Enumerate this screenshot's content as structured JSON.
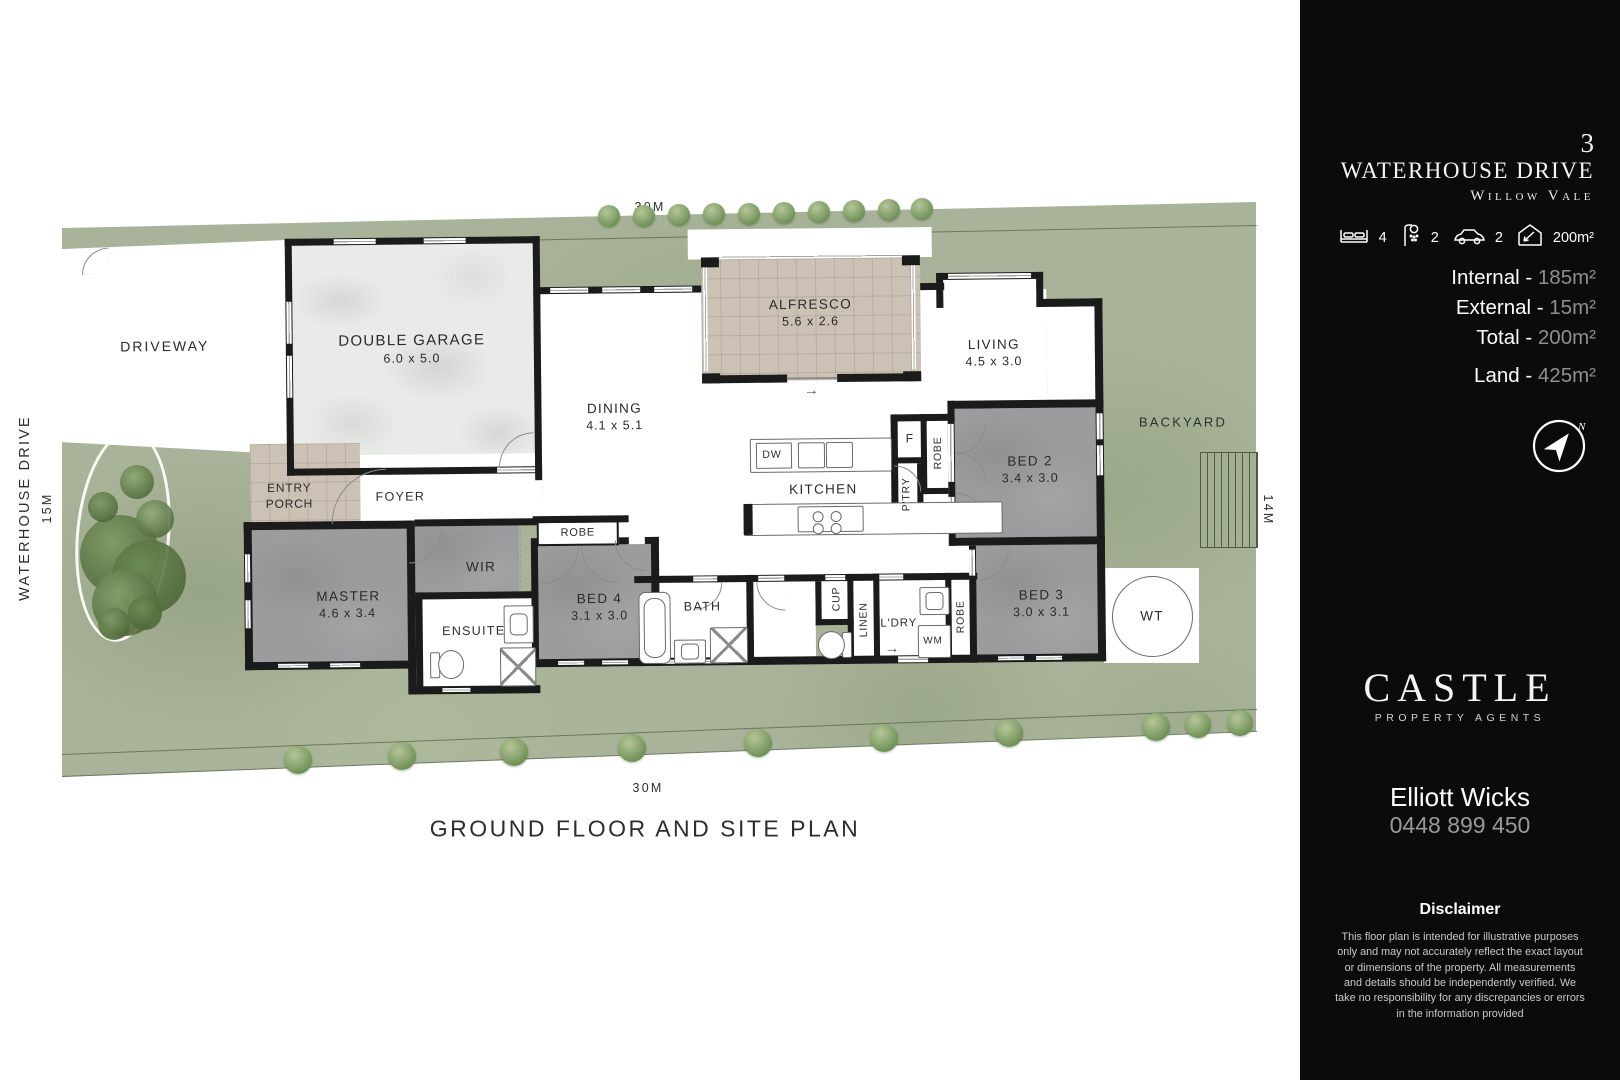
{
  "plan": {
    "labels": {
      "street_side": "WATERHOUSE DRIVE",
      "street_len": "15M",
      "len_top": "30M",
      "len_bottom": "30M",
      "len_right": "14M",
      "driveway": "DRIVEWAY",
      "garage": "DOUBLE GARAGE",
      "garage_dim": "6.0 x 5.0",
      "entry1": "ENTRY",
      "entry2": "PORCH",
      "foyer": "FOYER",
      "dining": "DINING",
      "dining_dim": "4.1 x 5.1",
      "alfresco": "ALFRESCO",
      "alfresco_dim": "5.6 x 2.6",
      "living": "LIVING",
      "living_dim": "4.5 x 3.0",
      "kitchen": "KITCHEN",
      "dw": "DW",
      "fridge": "F",
      "pantry": "P'TRY",
      "robe_bed2": "ROBE",
      "bed2": "BED 2",
      "bed2_dim": "3.4 x 3.0",
      "bed3": "BED 3",
      "bed3_dim": "3.0 x 3.1",
      "robe_bed3": "ROBE",
      "master": "MASTER",
      "master_dim": "4.6 x 3.4",
      "wir": "WIR",
      "ensuite": "ENSUITE",
      "robe_bed4": "ROBE",
      "bed4": "BED 4",
      "bed4_dim": "3.1 x 3.0",
      "bath": "BATH",
      "cup": "CUP",
      "linen": "LINEN",
      "ldry": "L'DRY",
      "wm": "WM",
      "backyard": "BACKYARD",
      "water_tank": "WT",
      "title": "GROUND FLOOR AND SITE PLAN"
    }
  },
  "sidebar": {
    "address": {
      "number": "3",
      "street": "WATERHOUSE DRIVE",
      "suburb": "Willow Vale"
    },
    "features": {
      "beds": "4",
      "baths": "2",
      "cars": "2",
      "area": "200m²"
    },
    "stats": [
      {
        "label": "Internal -",
        "value": "185m²"
      },
      {
        "label": "External -",
        "value": "15m²"
      },
      {
        "label": "Total -",
        "value": "200m²"
      },
      {
        "label": "Land -",
        "value": "425m²"
      }
    ],
    "compass_north": "N",
    "brand": {
      "name": "CASTLE",
      "tagline": "PROPERTY AGENTS"
    },
    "agent": {
      "name": "Elliott Wicks",
      "phone": "0448 899 450"
    },
    "disclaimer": {
      "title": "Disclaimer",
      "body": "This floor plan is intended for illustrative purposes only and may not accurately reflect the exact layout or dimensions of the property. All measurements and details should be independently verified. We take no responsibility for any discrepancies or errors in the information provided"
    }
  }
}
